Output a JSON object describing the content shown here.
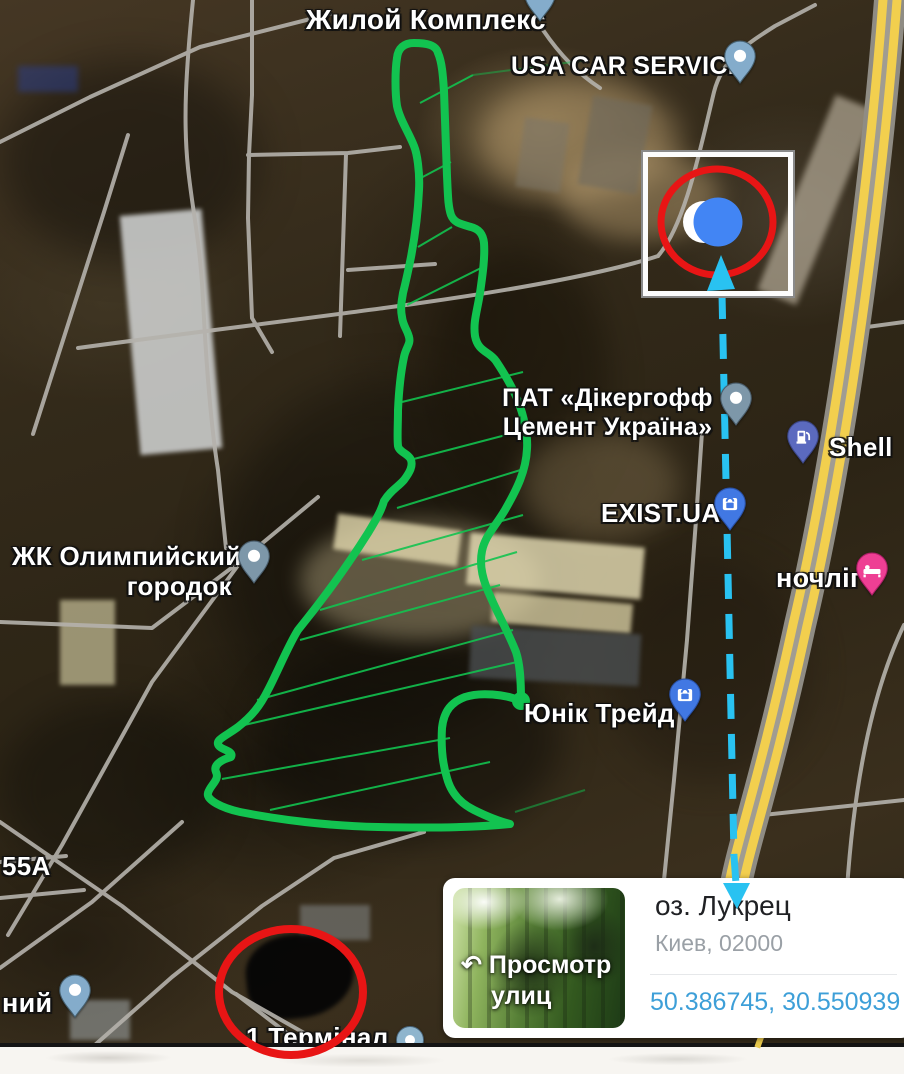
{
  "map": {
    "labels": {
      "residential_complex": "Жилой Комплекс",
      "usa_car_service": "USA CAR SERVICE",
      "dyckerhoff_1": "ПАТ «Дікергофф",
      "dyckerhoff_2": "Цемент Україна»",
      "shell": "Shell",
      "exist_ua": "EXIST.UA",
      "nochlig": "ночліг",
      "olimpiysky_1": "ЖК Олимпийский",
      "olimpiysky_2": "городок",
      "yunik_trade": "Юнік Трейд",
      "house_55a": "55А",
      "niy_partial": "ний",
      "terminal_1": "1 Термінал"
    },
    "icons": {
      "residential_complex": "teardrop-pin",
      "usa_car_service": "teardrop-pin",
      "dyckerhoff": "teardrop-pin",
      "olimpiysky": "teardrop-pin",
      "niy": "teardrop-pin",
      "shell": "fuel-pump-pin",
      "exist_ua": "shopping-bag-pin",
      "yunik_trade": "shopping-bag-pin",
      "nochlig": "bed-pin",
      "terminal_1": "circle-pin",
      "inset": "blue-location-dot"
    }
  },
  "info_card": {
    "title": "оз. Лукрец",
    "subtitle": "Киев, 02000",
    "coordinates": "50.386745, 30.550939",
    "street_view_icon": "↶",
    "street_view_1": "Просмотр",
    "street_view_2": "улиц"
  },
  "colors": {
    "annotation_green": "#12c350",
    "annotation_red": "#e81515",
    "arrow_cyan": "#29c2f1",
    "highway_yellow": "#f2cf4e",
    "coordinates_blue": "#3d9fd8",
    "location_dot_blue": "#4285F4",
    "pin_blue": "#4178e3",
    "pin_pink": "#ee3f94",
    "pin_indigo": "#5b6abf",
    "pin_slate": "#7d97a9",
    "pin_lightblue": "#84accb"
  }
}
